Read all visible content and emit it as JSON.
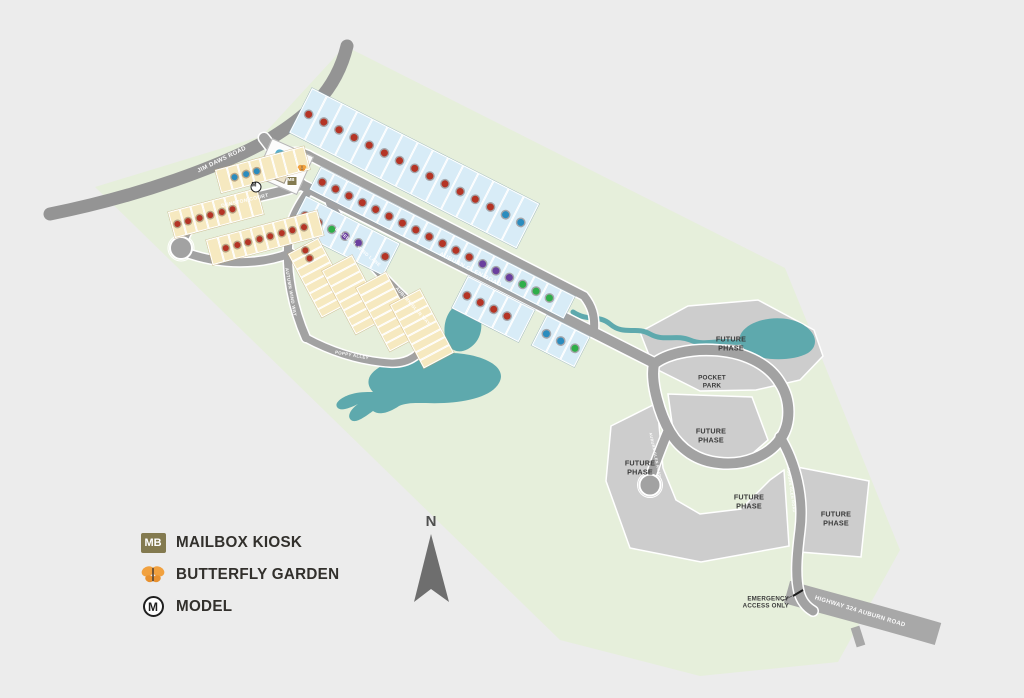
{
  "legend": {
    "items": [
      {
        "id": "mailbox-kiosk",
        "symbol": "MB",
        "label": "MAILBOX KIOSK"
      },
      {
        "id": "butterfly-garden",
        "label": "BUTTERFLY GARDEN"
      },
      {
        "id": "model",
        "symbol": "M",
        "label": "MODEL"
      }
    ]
  },
  "compass": {
    "label": "N"
  },
  "map": {
    "colors": {
      "background": "#ececec",
      "site_green": "#e6efdb",
      "future_gray": "#cdcdcd",
      "water": "#5ea9ad",
      "road": "#a2a2a2",
      "boundary_road": "#949494",
      "highway": "#a8a8a8",
      "lot_blue": "#d8ecf7",
      "lot_tan": "#f6e9c0"
    },
    "dot_colors": {
      "red": "#b43425",
      "blue": "#2b8cbe",
      "green": "#2fae49",
      "purple": "#6a3f9e"
    },
    "amenity": {
      "pool_label": "POOL"
    },
    "road_labels": [
      {
        "text": "JIM DAWS ROAD",
        "x": 222,
        "y": 160,
        "rot": -26,
        "size": 6
      },
      {
        "text": "DUNSTON COURT",
        "x": 245,
        "y": 201,
        "rot": -13,
        "size": 5
      },
      {
        "text": "AUBURN GLEN ROAD",
        "x": 470,
        "y": 270,
        "rot": 27,
        "size": 6
      },
      {
        "text": "BLUEBELL WIND LANE",
        "x": 358,
        "y": 247,
        "rot": 40,
        "size": 4.6
      },
      {
        "text": "AUTUMN WIND WAY",
        "x": 291,
        "y": 292,
        "rot": 80,
        "size": 4.5
      },
      {
        "text": "AUBURN GLEN WAY",
        "x": 413,
        "y": 306,
        "rot": 48,
        "size": 4.5
      },
      {
        "text": "POPPY ALLEY",
        "x": 352,
        "y": 355,
        "rot": 10,
        "size": 4.4
      },
      {
        "text": "AUBURN GLEN ROAD",
        "x": 655,
        "y": 455,
        "rot": 78,
        "size": 3.8
      },
      {
        "text": "AUBURN GLEN ROAD",
        "x": 791,
        "y": 490,
        "rot": 82,
        "size": 3.8
      },
      {
        "text": "HIGHWAY 324 AUBURN ROAD",
        "x": 860,
        "y": 612,
        "rot": 17,
        "size": 6
      }
    ],
    "area_labels": [
      {
        "text": "FUTURE\nPHASE",
        "x": 731,
        "y": 344,
        "size": 7.2
      },
      {
        "text": "FUTURE\nPHASE",
        "x": 711,
        "y": 436,
        "size": 7.2
      },
      {
        "text": "FUTURE\nPHASE",
        "x": 640,
        "y": 468,
        "size": 7.2
      },
      {
        "text": "FUTURE\nPHASE",
        "x": 749,
        "y": 502,
        "size": 7.2
      },
      {
        "text": "FUTURE\nPHASE",
        "x": 836,
        "y": 519,
        "size": 7.2
      },
      {
        "text": "POCKET\nPARK",
        "x": 712,
        "y": 382,
        "size": 6.4
      },
      {
        "text": "EMERGENCY\nACCESS ONLY",
        "x": 789,
        "y": 603,
        "size": 6.2,
        "align": "right"
      }
    ],
    "lot_strips": [
      {
        "x": 312,
        "y": 88,
        "rot": 27,
        "lot_w": 17,
        "depth": 50,
        "fill": "blue",
        "dots": [
          "red",
          "red",
          "red",
          "red",
          "red",
          "red",
          "red",
          "red",
          "red",
          "red",
          "red",
          "red",
          "red",
          "blue",
          "blue"
        ]
      },
      {
        "x": 321,
        "y": 167,
        "rot": 27,
        "lot_w": 15,
        "depth": 25,
        "fill": "blue",
        "dots": [
          "red",
          "red",
          "red",
          "red",
          "red",
          "red",
          "red",
          "red",
          "red",
          "red",
          "red",
          "red",
          "purple",
          "purple",
          "purple",
          "green",
          "green",
          "green",
          null
        ]
      },
      {
        "x": 306,
        "y": 196,
        "rot": 27,
        "lot_w": 15,
        "depth": 36,
        "fill": "blue",
        "dots": [
          "red",
          "red",
          "green",
          "purple",
          "purple",
          null,
          "red"
        ]
      },
      {
        "x": 468,
        "y": 276,
        "rot": 27,
        "lot_w": 15,
        "depth": 36,
        "fill": "blue",
        "dots": [
          "red",
          "red",
          "red",
          "red",
          null
        ]
      },
      {
        "x": 547,
        "y": 315,
        "rot": 27,
        "lot_w": 16,
        "depth": 34,
        "fill": "blue",
        "dots": [
          "blue",
          "blue",
          "green"
        ]
      },
      {
        "x": 215,
        "y": 170,
        "rot": -15,
        "lot_w": 11.5,
        "depth": 24,
        "fill": "tan",
        "dots": [
          null,
          "blue",
          "blue",
          "blue",
          null,
          null,
          null,
          null
        ]
      },
      {
        "x": 168,
        "y": 212,
        "rot": -15,
        "lot_w": 11.5,
        "depth": 27,
        "fill": "tan",
        "dots": [
          "red",
          "red",
          "red",
          "red",
          "red",
          "red",
          null,
          null
        ]
      },
      {
        "x": 206,
        "y": 240,
        "rot": -15,
        "lot_w": 11.5,
        "depth": 26,
        "fill": "tan",
        "dots": [
          null,
          "red",
          "red",
          "red",
          "red",
          "red",
          "red",
          "red",
          "red",
          null
        ]
      },
      {
        "x": 318,
        "y": 238,
        "rot": 62,
        "lot_w": 9,
        "depth": 34,
        "fill": "tan",
        "dots": [
          "red",
          "red",
          null,
          null,
          null,
          null,
          null,
          null
        ]
      },
      {
        "x": 352,
        "y": 255,
        "rot": 62,
        "lot_w": 9,
        "depth": 34,
        "fill": "tan",
        "dots": [
          null,
          null,
          null,
          null,
          null,
          null,
          null,
          null
        ]
      },
      {
        "x": 386,
        "y": 272,
        "rot": 62,
        "lot_w": 9,
        "depth": 34,
        "fill": "tan",
        "dots": [
          null,
          null,
          null,
          null,
          null,
          null,
          null,
          null
        ]
      },
      {
        "x": 420,
        "y": 289,
        "rot": 62,
        "lot_w": 9,
        "depth": 34,
        "fill": "tan",
        "dots": [
          null,
          null,
          null,
          null,
          null,
          null,
          null,
          null
        ]
      }
    ],
    "markers": [
      {
        "type": "mailbox-kiosk",
        "text": "MB",
        "x": 292,
        "y": 181
      },
      {
        "type": "butterfly-garden",
        "x": 302,
        "y": 168
      },
      {
        "type": "model",
        "text": "M",
        "x": 256,
        "y": 187
      }
    ]
  }
}
